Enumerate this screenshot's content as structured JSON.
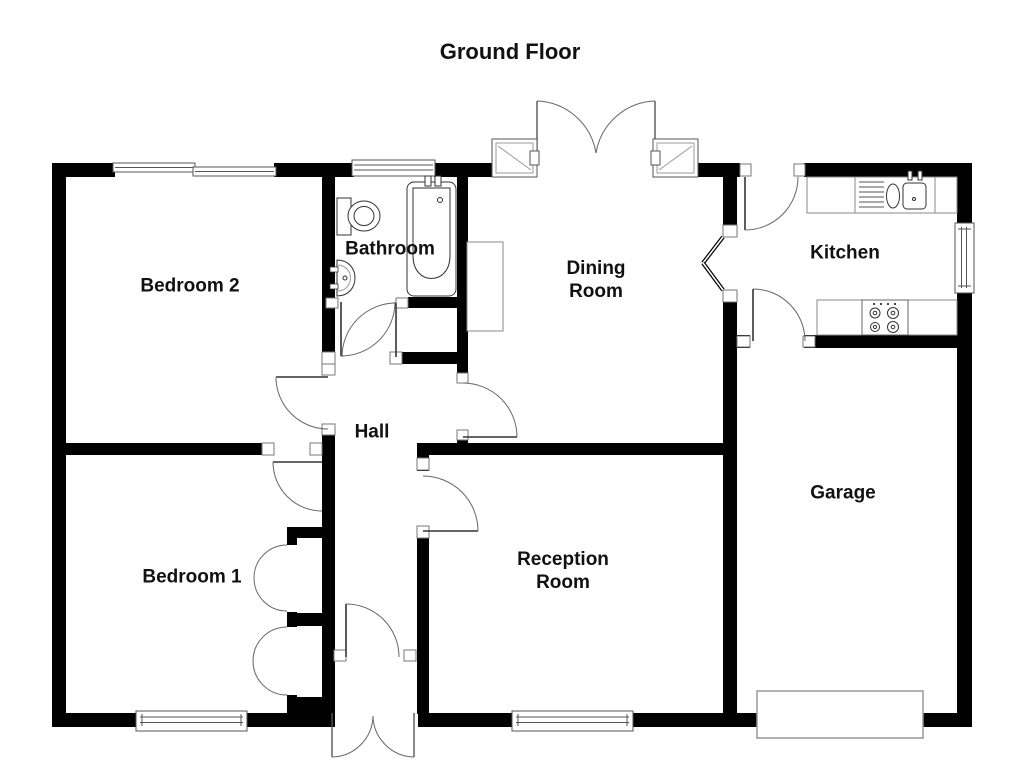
{
  "title": "Ground Floor",
  "rooms": {
    "bedroom2": "Bedroom 2",
    "bathroom": "Bathroom",
    "dining_room": "Dining Room",
    "kitchen": "Kitchen",
    "hall": "Hall",
    "bedroom1": "Bedroom 1",
    "reception_room": "Reception Room",
    "garage": "Garage"
  },
  "fixtures": {
    "bathroom": [
      "toilet",
      "wash-basin",
      "bathtub"
    ],
    "kitchen": [
      "worktop",
      "draining-board",
      "double-sink",
      "hob"
    ],
    "dining_room": [
      "chimney-breast",
      "french-doors",
      "corner-windows"
    ],
    "garage": [
      "garage-door"
    ],
    "hall": [
      "front-entrance-double-doors",
      "inner-front-door"
    ],
    "bedroom1": [
      "built-in-cupboards"
    ]
  },
  "windows": [
    "bedroom2-top-window",
    "bathroom-top-window",
    "kitchen-side-window",
    "bedroom1-bottom-window",
    "reception-bottom-window"
  ],
  "colors": {
    "background": "#ffffff",
    "wall": "#000000",
    "label_text": "#111111",
    "fixture_outline": "#333333",
    "thin_detail": "#888888"
  }
}
